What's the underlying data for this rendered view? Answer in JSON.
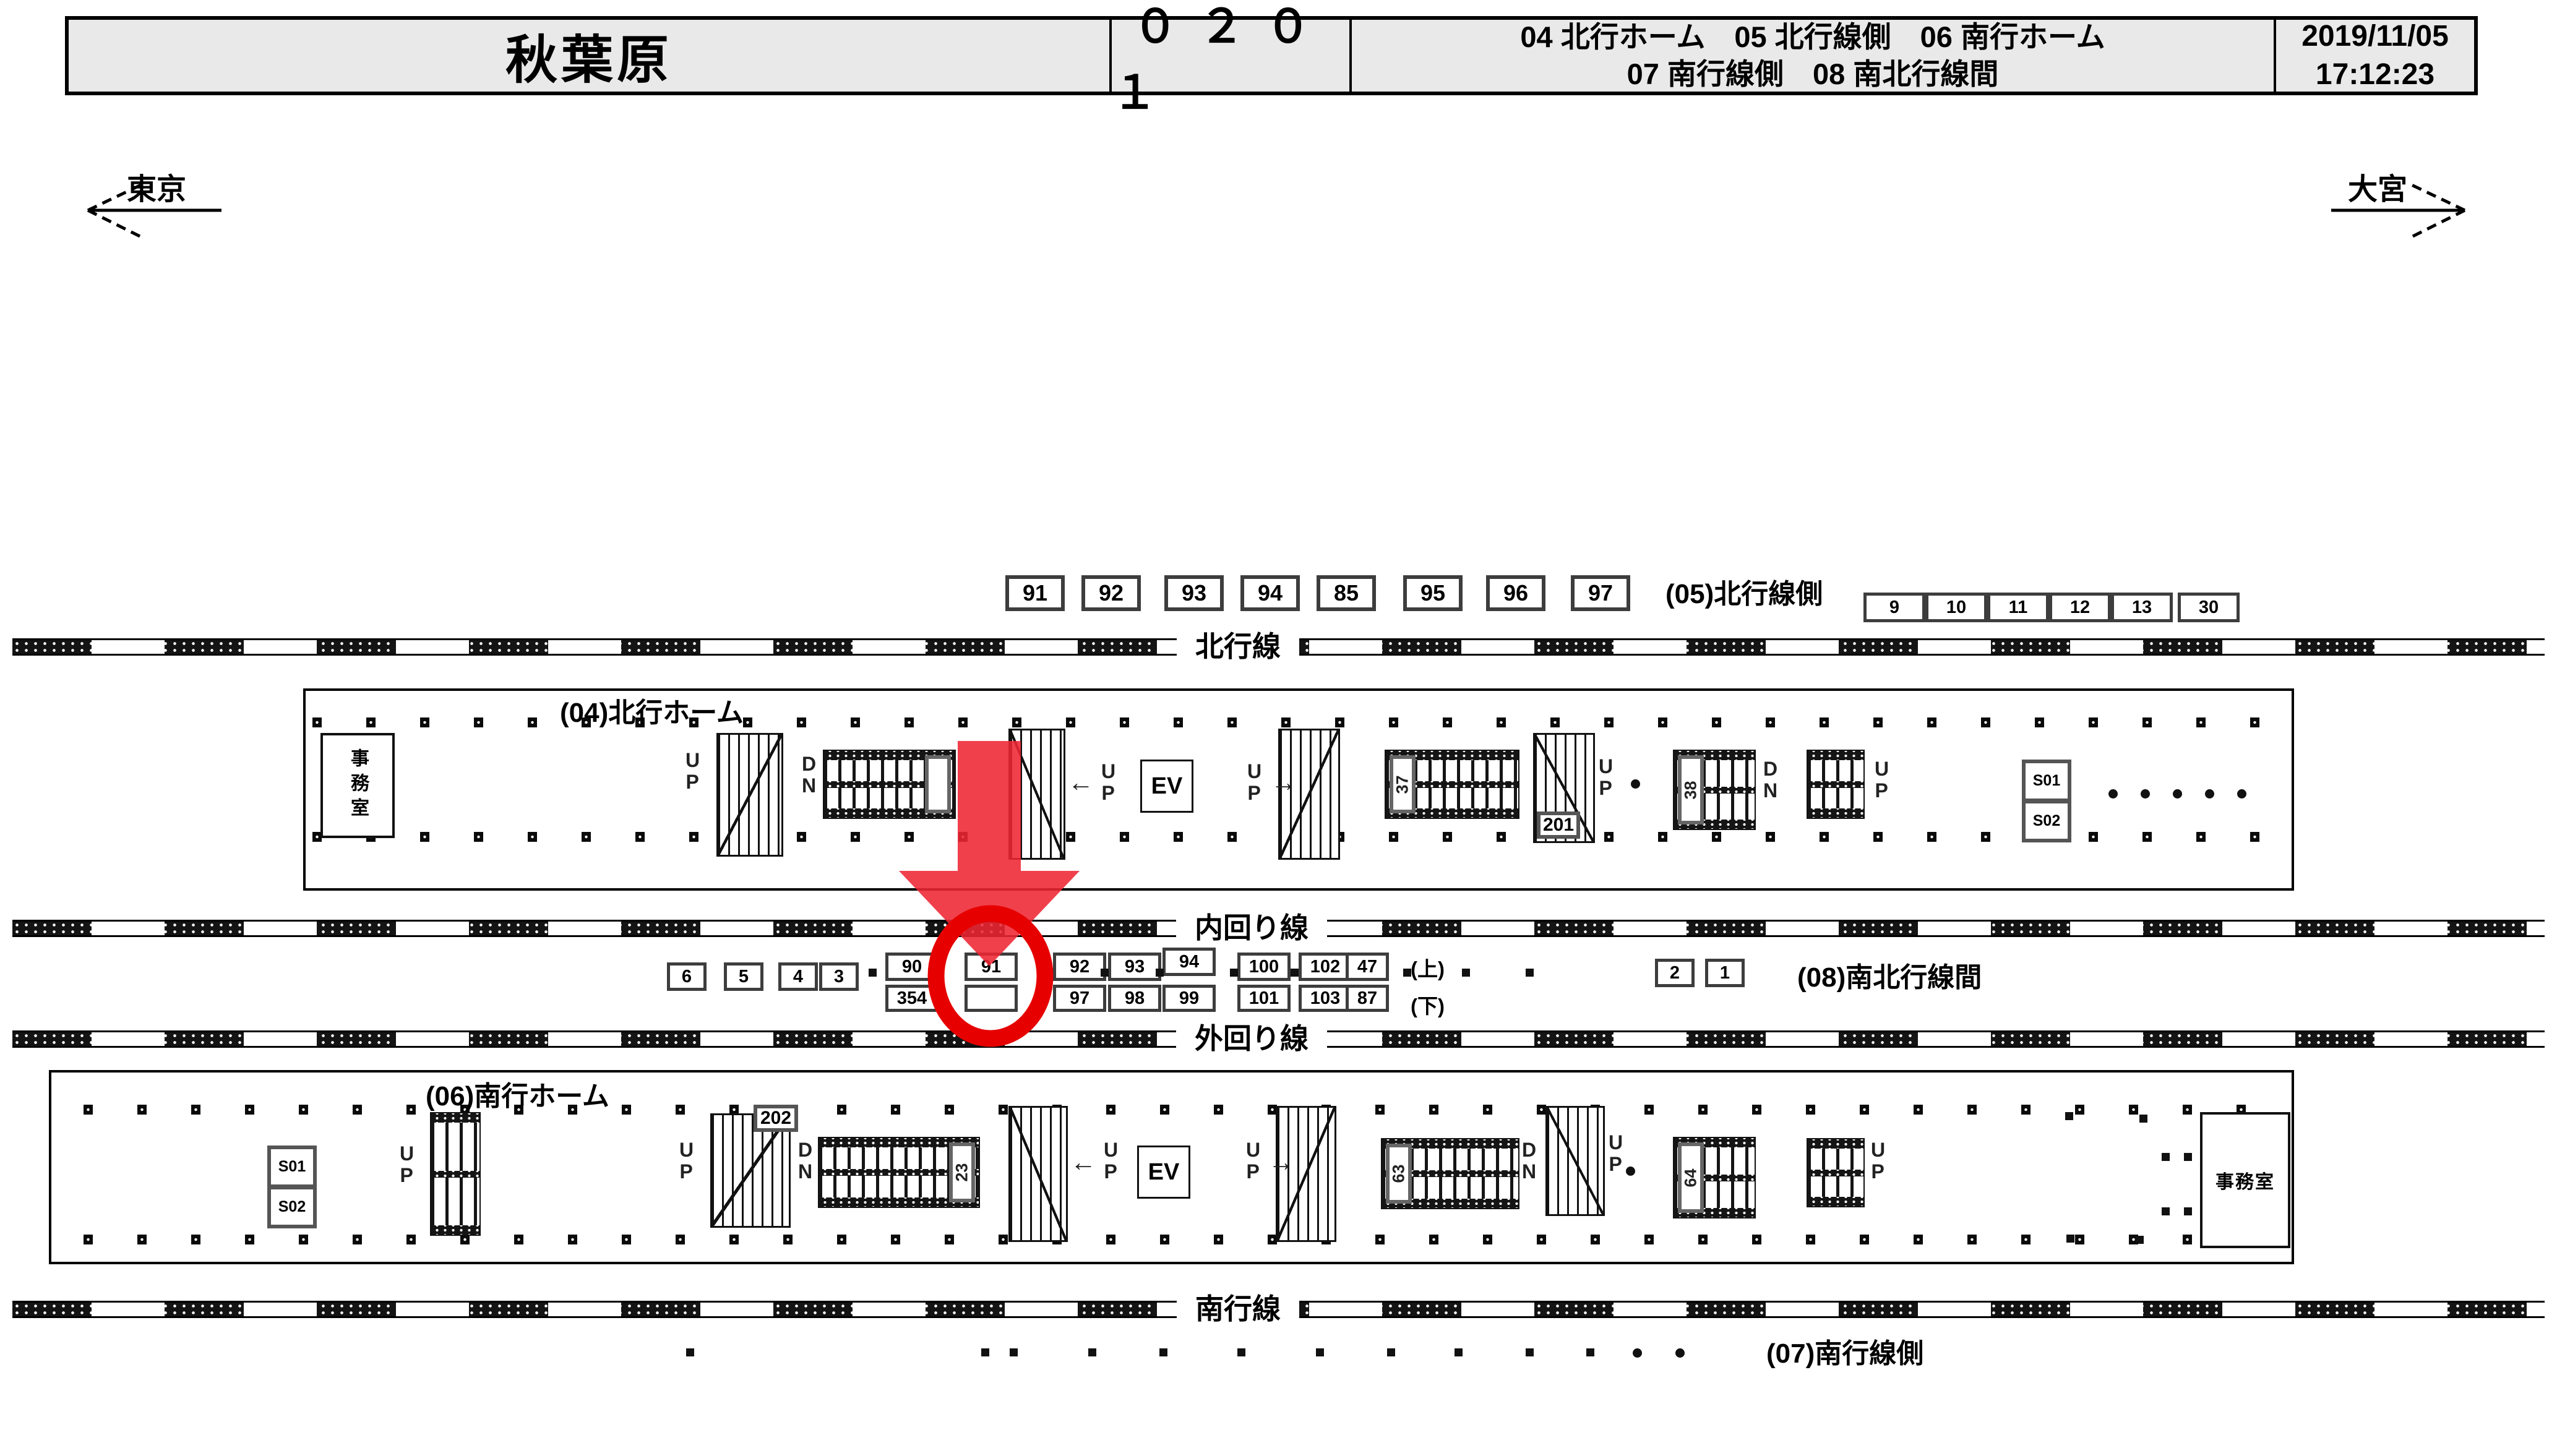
{
  "header": {
    "station": "秋葉原",
    "code": "０２０１",
    "desc_line1": "04 北行ホーム　05 北行線側　06 南行ホーム",
    "desc_line2": "07 南行線側　08 南北行線間",
    "date": "2019/11/05",
    "time": "17:12:23"
  },
  "directions": {
    "left": "東京",
    "right": "大宮"
  },
  "tracks": {
    "north": "北行線",
    "inner": "内回り線",
    "outer": "外回り線",
    "south": "南行線"
  },
  "areas": {
    "a04": "(04)北行ホーム",
    "a05": "(05)北行線側",
    "a06": "(06)南行ホーム",
    "a07": "(07)南行線側",
    "a08": "(08)南北行線間"
  },
  "cameras": {
    "north_row": [
      "91",
      "92",
      "93",
      "94",
      "85",
      "95",
      "96",
      "97"
    ],
    "north_right_row": [
      "9",
      "10",
      "11",
      "12",
      "13",
      "30"
    ],
    "mid_singles": [
      "6",
      "5",
      "4",
      "3"
    ],
    "mid_pairs": [
      [
        "90",
        "354"
      ],
      [
        "91",
        ""
      ],
      [
        "92",
        "97"
      ],
      [
        "93",
        "98"
      ],
      [
        "94",
        "99"
      ],
      [
        "100",
        "101"
      ],
      [
        "102",
        "103"
      ],
      [
        "47",
        "87"
      ]
    ],
    "updown_labels": [
      "(上)",
      "(下)"
    ],
    "mid_right": [
      "2",
      "1"
    ]
  },
  "fixtures": {
    "office": "事務室",
    "ev": "EV",
    "up": "UP",
    "dn": "DN",
    "s01": "S01",
    "s02": "S02",
    "p201": "201",
    "p202": "202",
    "e37": "37",
    "e38": "38",
    "e23": "23",
    "e63": "63",
    "e64": "64",
    "arrow_left": "←",
    "arrow_right": "→"
  },
  "highlight": {
    "circled_camera": "91",
    "circle_color": "#e60000",
    "arrow_color": "#ee2633"
  }
}
